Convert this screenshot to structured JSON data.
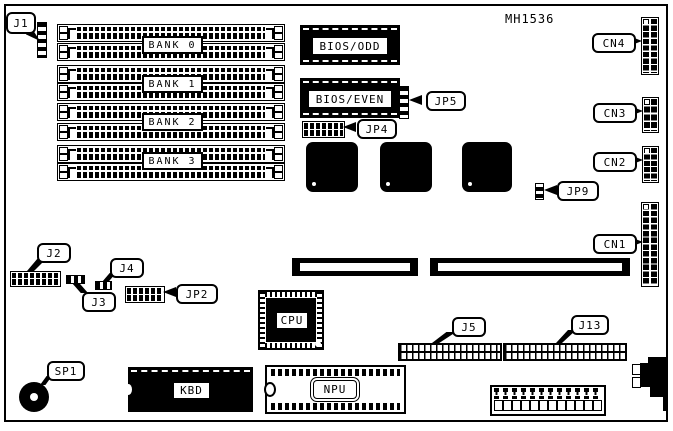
{
  "board": {
    "part_number": "MH1536",
    "colors": {
      "ink": "#000000",
      "background": "#ffffff"
    },
    "banks": [
      {
        "label": "BANK 0"
      },
      {
        "label": "BANK 1"
      },
      {
        "label": "BANK 2"
      },
      {
        "label": "BANK 3"
      }
    ],
    "chips": {
      "bios_odd": "BIOS/ODD",
      "bios_even": "BIOS/EVEN",
      "cpu": "CPU",
      "kbd": "KBD",
      "npu": "NPU"
    },
    "callouts": {
      "j1": "J1",
      "j2": "J2",
      "j3": "J3",
      "j4": "J4",
      "j5": "J5",
      "j13": "J13",
      "jp2": "JP2",
      "jp4": "JP4",
      "jp5": "JP5",
      "jp9": "JP9",
      "cn1": "CN1",
      "cn2": "CN2",
      "cn3": "CN3",
      "cn4": "CN4",
      "sp1": "SP1"
    }
  }
}
